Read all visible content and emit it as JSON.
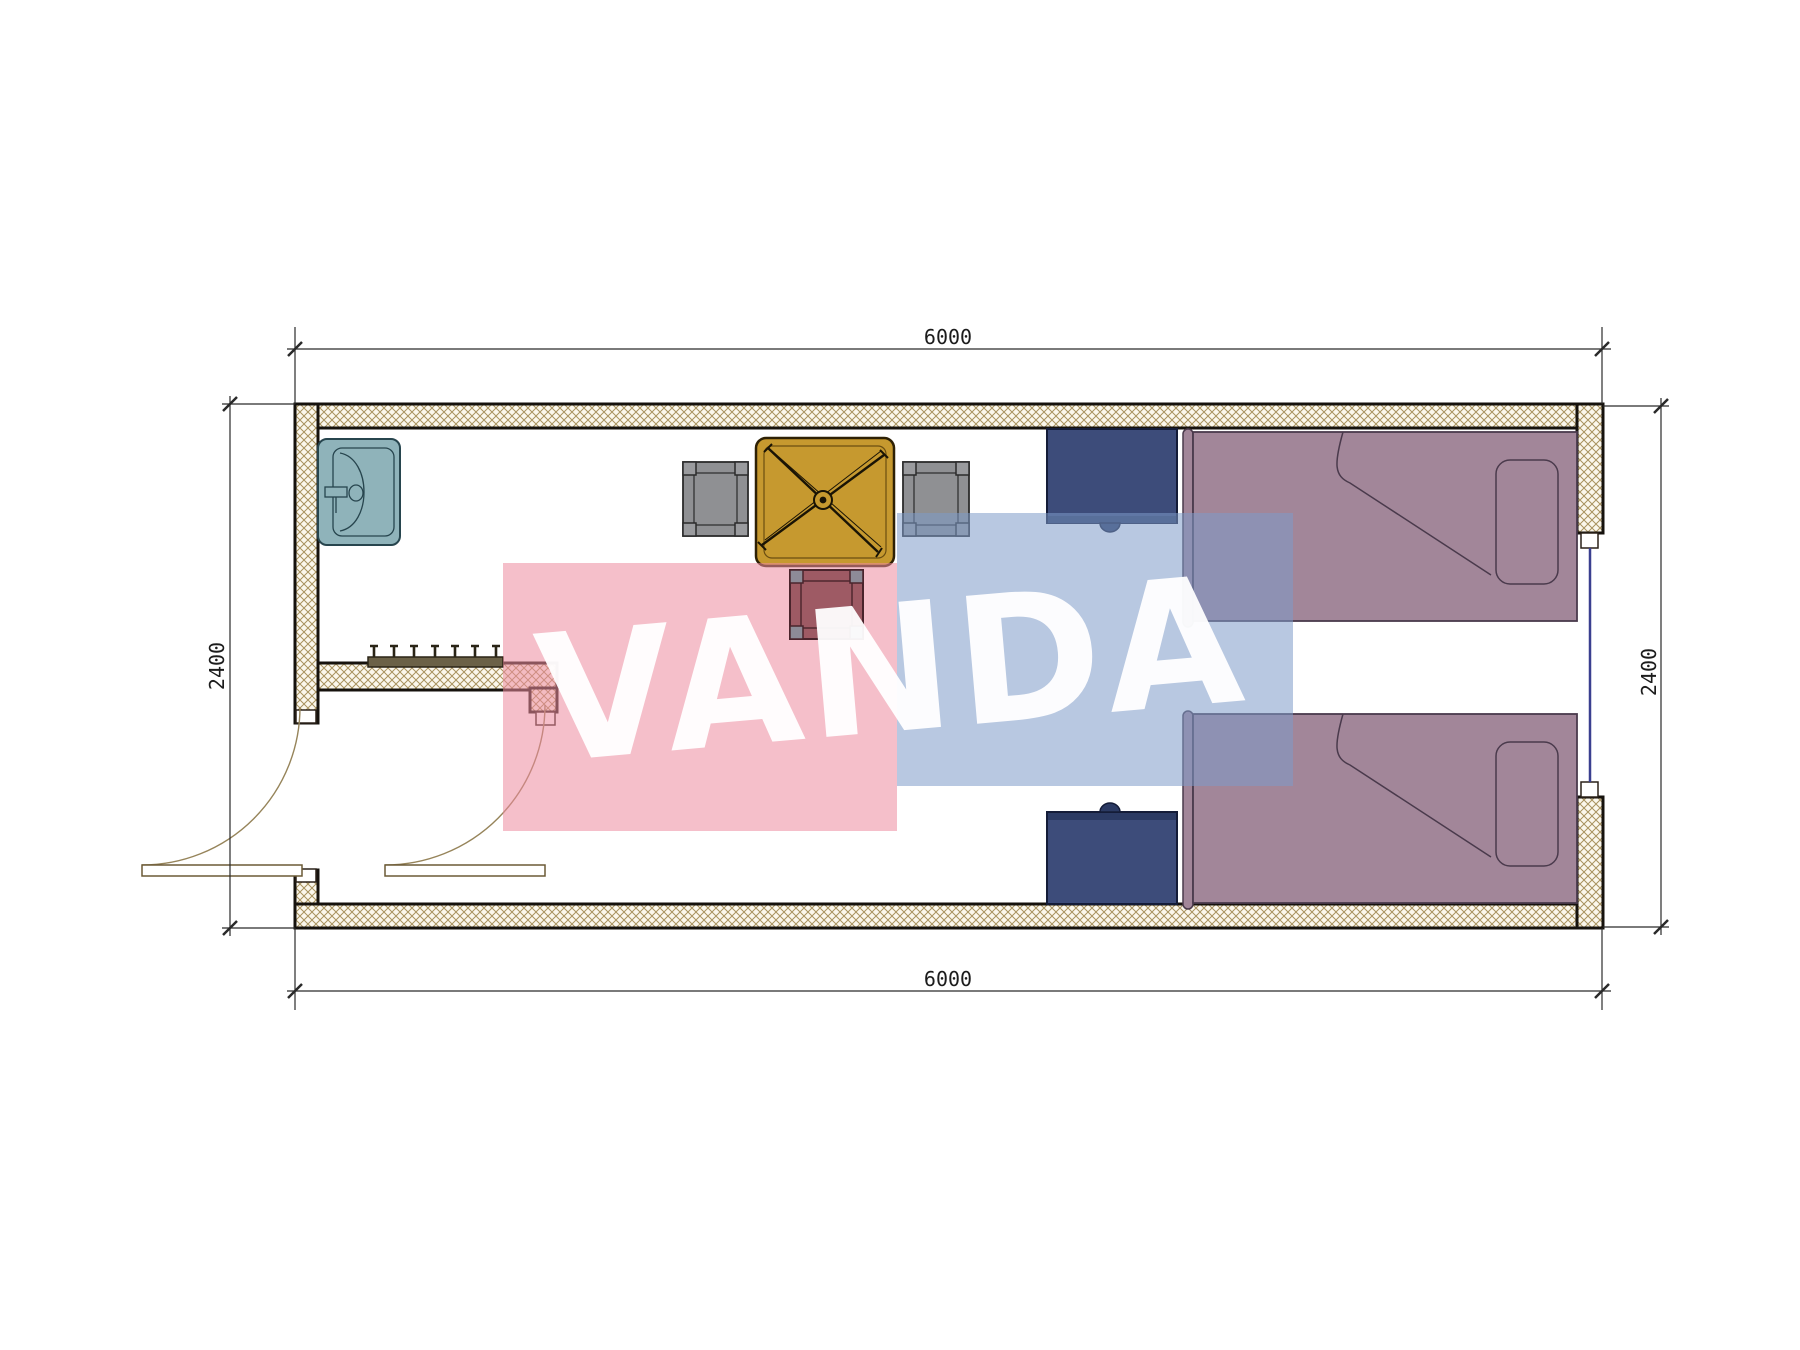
{
  "watermark": {
    "text": "VANDA"
  },
  "dimensions": {
    "top": "6000",
    "bottom": "6000",
    "left": "2400",
    "right": "2400"
  },
  "palette": {
    "wall_hatch": "#a8925e",
    "wall_fill": "#fbf7ec",
    "wall_line": "#16120d",
    "pink_overlay": "#ec8a9e",
    "blue_overlay": "#7e9ac9",
    "watermark_text": "#ffffff",
    "bed": "#a28699",
    "bed_line": "#4a3a4c",
    "nightstand": "#3d4c7a",
    "nightstand_dark": "#2b3a63",
    "table": "#c6992f",
    "table_line": "#2e2105",
    "chair_gray": "#8f9093",
    "chair_red_tinted": "#9e5a64",
    "chair_red_post": "#8d8b97",
    "sink": "#8fb3ba",
    "sink_line": "#27454e",
    "window_line": "#3a3f8f",
    "door_arc": "#96845a",
    "coat_rack": "#6b6147",
    "dim_line": "#2a2a2a"
  }
}
